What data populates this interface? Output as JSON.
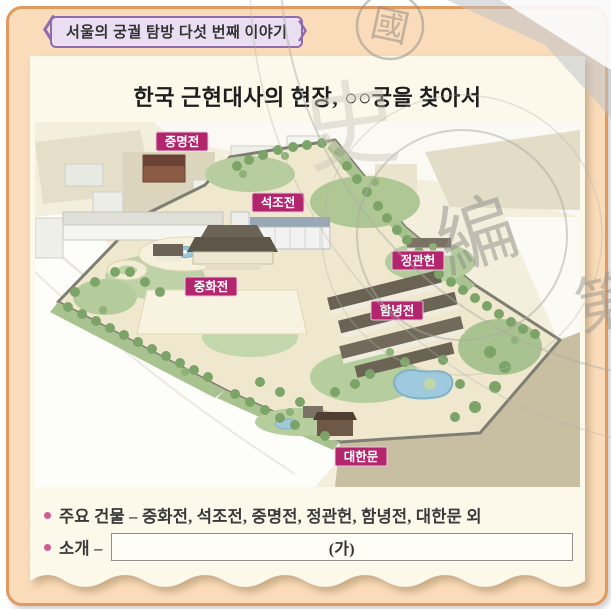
{
  "header": {
    "tab_label": "서울의 궁궐 탐방 다섯 번째 이야기"
  },
  "title": "한국 근현대사의 현장, ○○궁을 찾아서",
  "map": {
    "labels": [
      {
        "text": "중명전"
      },
      {
        "text": "석조전"
      },
      {
        "text": "정관헌"
      },
      {
        "text": "중화전"
      },
      {
        "text": "함녕전"
      },
      {
        "text": "대한문"
      }
    ]
  },
  "notes": {
    "bullet1": "주요 건물 – 중화전, 석조전, 중명전, 정관헌, 함녕전, 대한문 외",
    "bullet2_label": "소개 –",
    "answer_placeholder": "(가)"
  },
  "watermark": {
    "seal": "國",
    "char_large": "編",
    "char_right": "第",
    "char_faint": "史"
  },
  "colors": {
    "accent_magenta": "#B3266E",
    "tab_purple": "#8E6CAC",
    "panel_peach": "#FBDCBA",
    "panel_border": "#E09A60",
    "paper_cream": "#FCF8EA",
    "bullet_pink": "#D45C96"
  }
}
